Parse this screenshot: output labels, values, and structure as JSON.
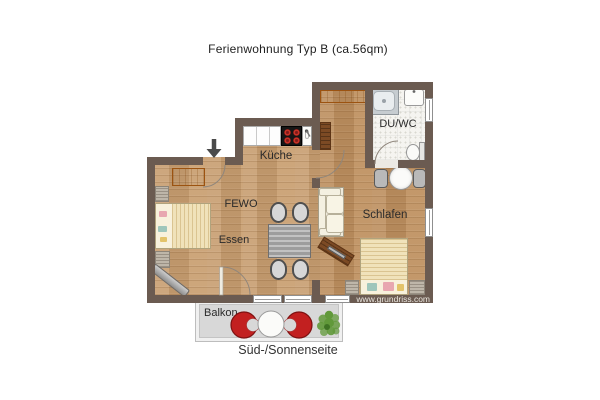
{
  "title": "Ferienwohnung Typ B (ca.56qm)",
  "rooms": {
    "kitchen": "Küche",
    "living": "FEWO",
    "dining": "Essen",
    "bedroom": "Schlafen",
    "bath": "DU/WC",
    "balcony": "Balkon"
  },
  "caption": "Süd-/Sonnenseite",
  "watermark": "www.grundriss.com",
  "icons": {
    "entrance_arrow": "down-arrow",
    "door_swing": "quarter-arc",
    "plant": "shrub-cluster"
  },
  "colors": {
    "wall": "#6b5b51",
    "wood_light": "#c79e72",
    "wood_dark": "#bc8f60",
    "accent_orange": "#d9782a",
    "furniture_brown": "#7c4a24",
    "chair_red": "#c22020",
    "plant_green": "#61993a",
    "balcony_floor": "#d8d8d8"
  }
}
